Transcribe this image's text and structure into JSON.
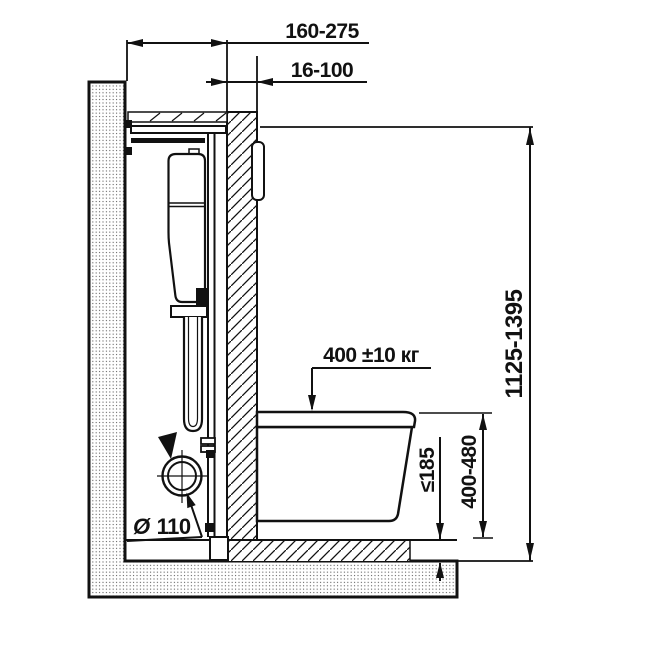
{
  "drawing_texts": {
    "frame_depth": "160-275",
    "facing_thickness": "16-100",
    "frame_height": "1125-1395",
    "load_capacity": "400 ±10 кг",
    "bowl_height": "400-480",
    "floor_buildup_max": "≤185",
    "drain_symbol": "Ø",
    "drain_diameter": "110"
  },
  "colors": {
    "line": "#111111",
    "background": "#ffffff",
    "stipple_dot": "#5a5a5a"
  }
}
